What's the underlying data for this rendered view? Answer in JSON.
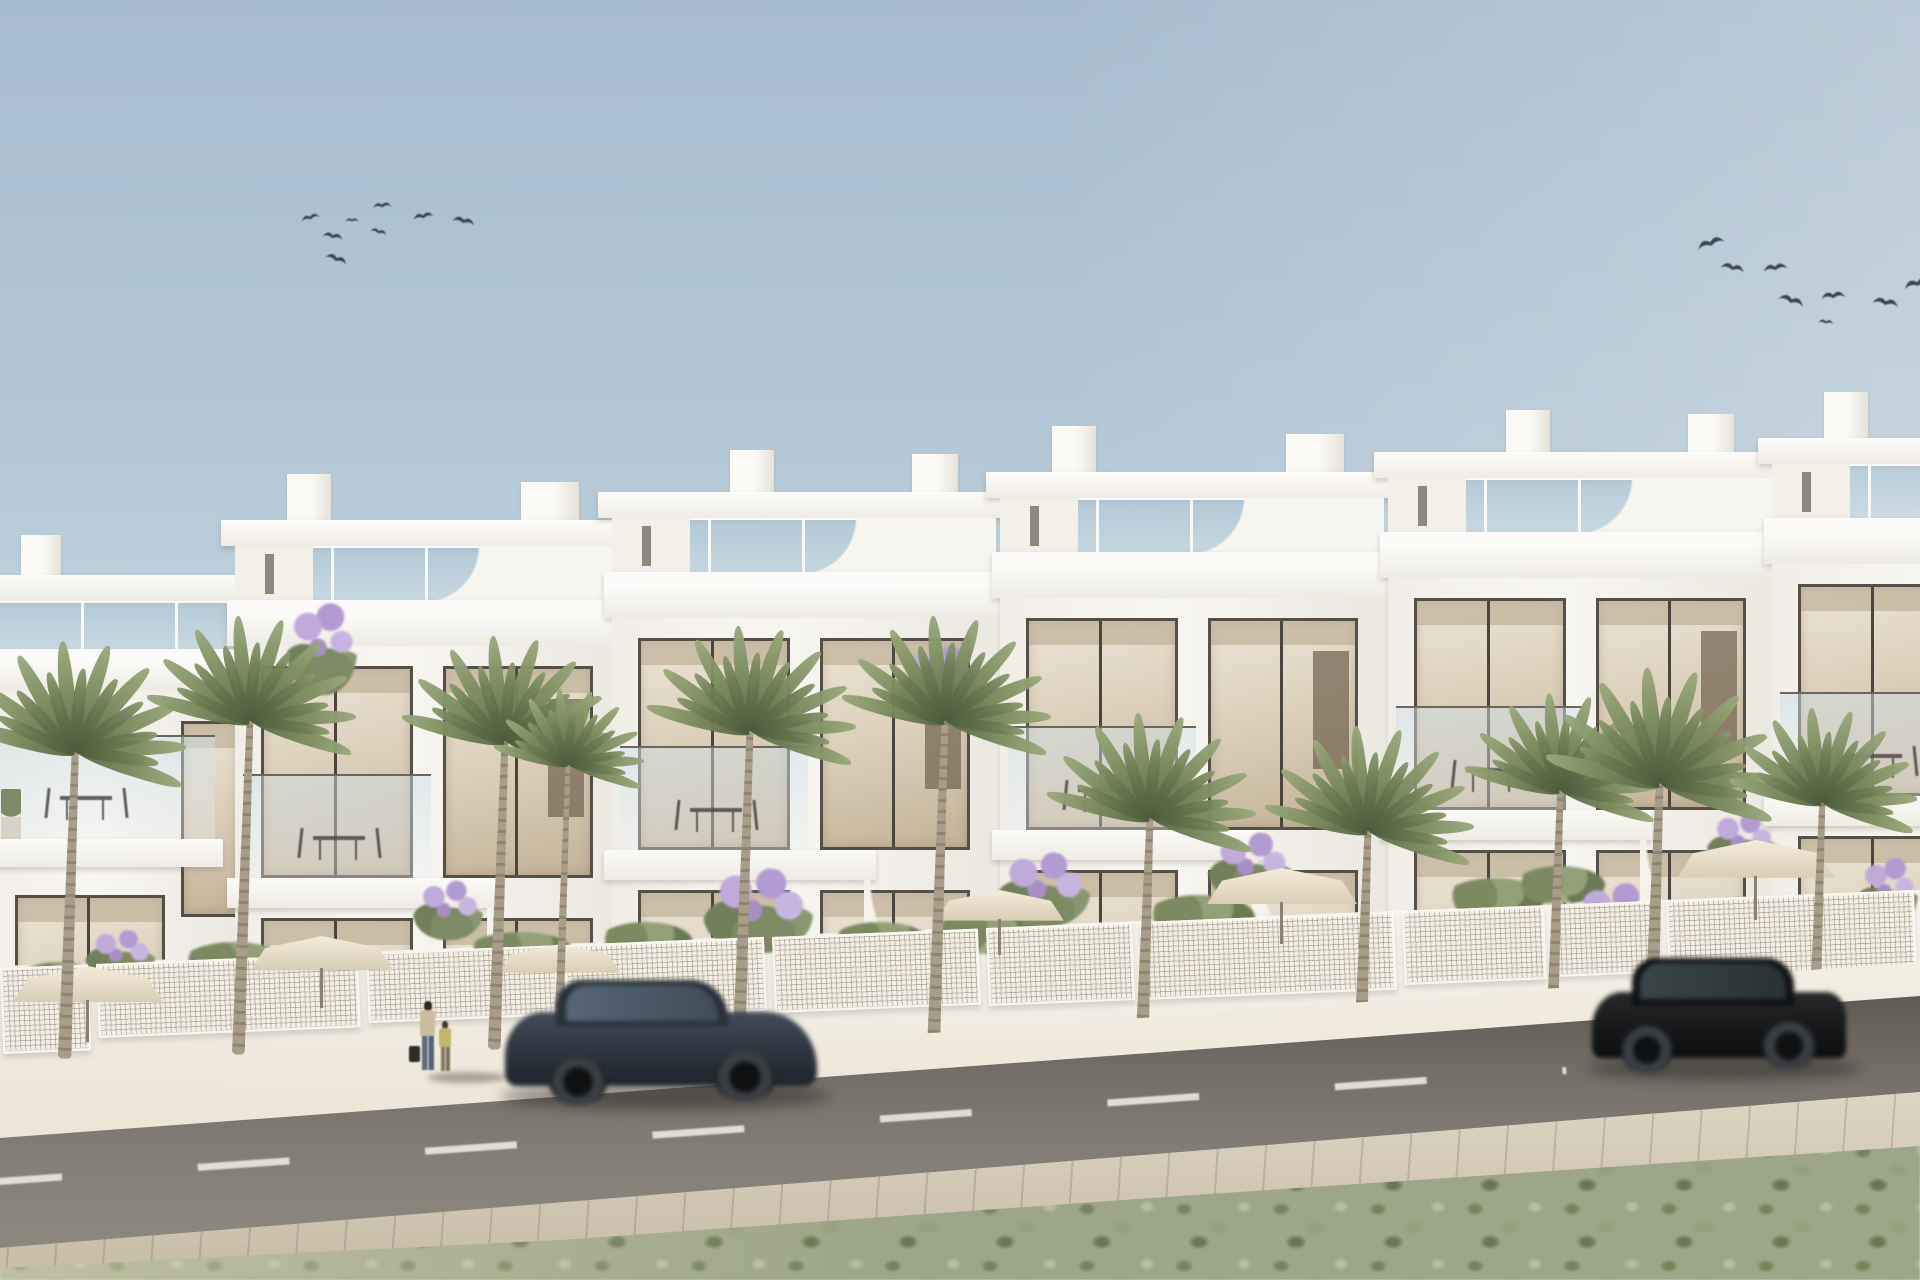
{
  "meta": {
    "kind": "architectural-exterior-render",
    "description": "Photorealistic render of a row of modern white Mediterranean townhouses with rooftop terraces, glass balustrades, large windows, front gardens with palm trees, lavender, parasols and white lattice fences, a diagonal asphalt road with two motion-blurred cars, two pedestrians on the sidewalk, and two flocks of birds in a hazy blue sky",
    "width_px": 1920,
    "height_px": 1280
  },
  "palette": {
    "sky_top": "#a7bccd",
    "sky_horizon": "#eef4f6",
    "building_white": "#f4f1ec",
    "building_shadow": "#e6e2da",
    "window_frame": "#544f47",
    "window_glass_warm": "#d6c9b4",
    "terrace_glass": "#b0c7d4",
    "lattice_fence": "#f4efe5",
    "sidewalk": "#f0e9dc",
    "road_asphalt": "#716c65",
    "road_marking": "#e9e6de",
    "lower_pavement": "#d2c8b4",
    "scrub_green": "#9ea689",
    "palm_frond": "#7b8b5e",
    "palm_trunk": "#a0957f",
    "lavender": "#b29ad2",
    "car_sedan_navy": "#2b3440",
    "car_suv_black": "#141618",
    "bird_silhouette": "#2e3a46"
  },
  "sky": {
    "flocks": [
      {
        "id": "left",
        "bird_count": 8
      },
      {
        "id": "right",
        "bird_count": 8
      }
    ]
  },
  "birds": {
    "left": [
      {
        "x": 300,
        "y": 210,
        "s": 20,
        "r": -15
      },
      {
        "x": 322,
        "y": 228,
        "s": 22,
        "r": 10
      },
      {
        "x": 325,
        "y": 250,
        "s": 24,
        "r": 20
      },
      {
        "x": 372,
        "y": 198,
        "s": 20,
        "r": -5
      },
      {
        "x": 370,
        "y": 225,
        "s": 18,
        "r": 15
      },
      {
        "x": 412,
        "y": 208,
        "s": 22,
        "r": -10
      },
      {
        "x": 452,
        "y": 212,
        "s": 24,
        "r": 12
      },
      {
        "x": 345,
        "y": 215,
        "s": 14,
        "r": 0
      }
    ],
    "right": [
      {
        "x": 1695,
        "y": 232,
        "s": 30,
        "r": -18
      },
      {
        "x": 1720,
        "y": 258,
        "s": 26,
        "r": 12
      },
      {
        "x": 1762,
        "y": 258,
        "s": 26,
        "r": -8
      },
      {
        "x": 1778,
        "y": 290,
        "s": 28,
        "r": 18
      },
      {
        "x": 1820,
        "y": 286,
        "s": 26,
        "r": -5
      },
      {
        "x": 1872,
        "y": 292,
        "s": 28,
        "r": 10
      },
      {
        "x": 1902,
        "y": 272,
        "s": 30,
        "r": -15
      },
      {
        "x": 1818,
        "y": 316,
        "s": 16,
        "r": 5
      }
    ]
  },
  "houses": {
    "unit_count": 6,
    "style": "modern white stacked volumes, flat roofs, roof-terrace glass balustrades, curved scooped party walls, dark-framed floor-to-ceiling glazing",
    "modules": [
      {
        "left": 235,
        "top": 520,
        "variant": "va"
      },
      {
        "left": 612,
        "top": 492,
        "variant": "vb"
      },
      {
        "left": 1000,
        "top": 472,
        "variant": "va"
      },
      {
        "left": 1388,
        "top": 452,
        "variant": "vb"
      },
      {
        "left": 1772,
        "top": 438,
        "variant": "va"
      }
    ],
    "left_partial": {
      "left": -15,
      "top": 575
    }
  },
  "garden": {
    "lattice_panels": [
      {
        "x": 0,
        "w": 88,
        "h": 86
      },
      {
        "x": 96,
        "w": 262,
        "h": 74
      },
      {
        "x": 366,
        "w": 190,
        "h": 70
      },
      {
        "x": 564,
        "w": 200,
        "h": 74
      },
      {
        "x": 772,
        "w": 206,
        "h": 76
      },
      {
        "x": 986,
        "w": 146,
        "h": 78
      },
      {
        "x": 1140,
        "w": 254,
        "h": 78
      },
      {
        "x": 1402,
        "w": 142,
        "h": 74
      },
      {
        "x": 1552,
        "w": 106,
        "h": 72
      },
      {
        "x": 1666,
        "w": 248,
        "h": 84
      }
    ],
    "palms": [
      {
        "x": 75,
        "y": 695,
        "s": 1.05
      },
      {
        "x": 250,
        "y": 668,
        "s": 1.0
      },
      {
        "x": 505,
        "y": 688,
        "s": 1.0
      },
      {
        "x": 568,
        "y": 728,
        "s": 0.72
      },
      {
        "x": 750,
        "y": 678,
        "s": 1.0
      },
      {
        "x": 945,
        "y": 668,
        "s": 1.0
      },
      {
        "x": 1150,
        "y": 765,
        "s": 1.0
      },
      {
        "x": 1368,
        "y": 778,
        "s": 1.0
      },
      {
        "x": 1560,
        "y": 742,
        "s": 0.92
      },
      {
        "x": 1660,
        "y": 725,
        "s": 1.1
      },
      {
        "x": 1822,
        "y": 755,
        "s": 0.9
      }
    ],
    "lavender": [
      {
        "x": 322,
        "y": 600,
        "w": 70,
        "h": 95
      },
      {
        "x": 940,
        "y": 645,
        "w": 90,
        "h": 80
      },
      {
        "x": 120,
        "y": 930,
        "w": 70,
        "h": 50
      },
      {
        "x": 448,
        "y": 880,
        "w": 70,
        "h": 60
      },
      {
        "x": 758,
        "y": 868,
        "w": 110,
        "h": 85
      },
      {
        "x": 1042,
        "y": 852,
        "w": 95,
        "h": 75
      },
      {
        "x": 1250,
        "y": 832,
        "w": 85,
        "h": 70
      },
      {
        "x": 1615,
        "y": 882,
        "w": 90,
        "h": 80
      },
      {
        "x": 1742,
        "y": 812,
        "w": 70,
        "h": 60
      },
      {
        "x": 1888,
        "y": 856,
        "w": 60,
        "h": 70
      }
    ],
    "shrubs": [
      {
        "x": 60,
        "y": 962,
        "w": 95,
        "h": 42
      },
      {
        "x": 235,
        "y": 942,
        "w": 110,
        "h": 45
      },
      {
        "x": 520,
        "y": 932,
        "w": 110,
        "h": 42
      },
      {
        "x": 645,
        "y": 922,
        "w": 95,
        "h": 40
      },
      {
        "x": 880,
        "y": 922,
        "w": 100,
        "h": 42
      },
      {
        "x": 985,
        "y": 912,
        "w": 105,
        "h": 42
      },
      {
        "x": 1200,
        "y": 895,
        "w": 110,
        "h": 44
      },
      {
        "x": 1495,
        "y": 878,
        "w": 100,
        "h": 40
      },
      {
        "x": 1560,
        "y": 866,
        "w": 90,
        "h": 38
      },
      {
        "x": 1745,
        "y": 898,
        "w": 110,
        "h": 44
      }
    ],
    "parasols": [
      {
        "x": 88,
        "y": 966,
        "s": 1.0
      },
      {
        "x": 322,
        "y": 936,
        "s": 0.95
      },
      {
        "x": 560,
        "y": 944,
        "s": 0.8
      },
      {
        "x": 1000,
        "y": 890,
        "s": 0.85
      },
      {
        "x": 1282,
        "y": 868,
        "s": 1.0
      },
      {
        "x": 1756,
        "y": 840,
        "s": 1.05
      }
    ]
  },
  "street": {
    "lane_marking": {
      "style": "dashed",
      "color": "#e9e6de"
    },
    "cars": [
      {
        "kind": "sedan",
        "finish": "navy-blue",
        "motion_blur": true,
        "heading": "right",
        "x": 505,
        "y": 978
      },
      {
        "kind": "suv",
        "finish": "black",
        "motion_blur": true,
        "heading": "left",
        "x": 1590,
        "y": 956
      }
    ],
    "pedestrians": [
      {
        "kind": "adult-with-bag",
        "x": 420,
        "y": 1001
      },
      {
        "kind": "child",
        "x": 439,
        "y": 1021
      }
    ]
  }
}
